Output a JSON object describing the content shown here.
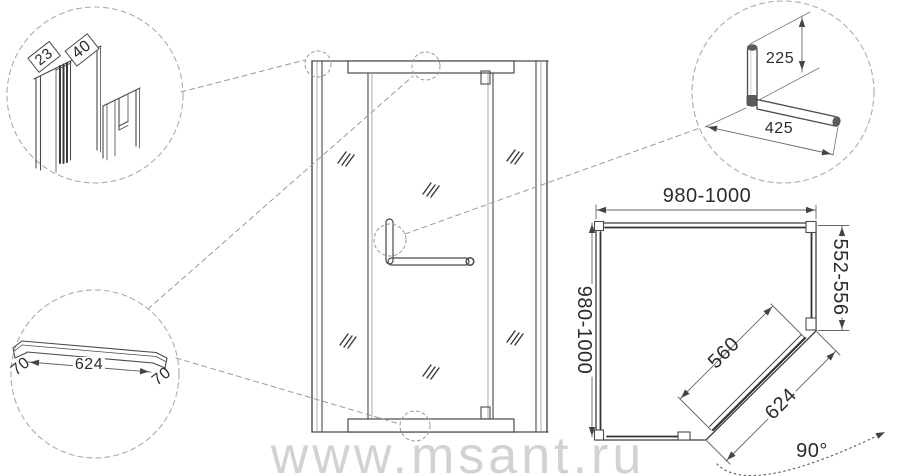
{
  "watermark": "www.msant.ru",
  "detail_profile": {
    "front": "23",
    "side": "40"
  },
  "detail_sill": {
    "left_end": "70",
    "length": "624",
    "right_end": "70"
  },
  "detail_handle": {
    "vertical": "225",
    "horizontal": "425"
  },
  "plan": {
    "top_width": "980-1000",
    "left_depth": "980-1000",
    "right_side": "552-556",
    "door_glass_width": "560",
    "diagonal_width": "624",
    "opening_angle": "90°"
  }
}
